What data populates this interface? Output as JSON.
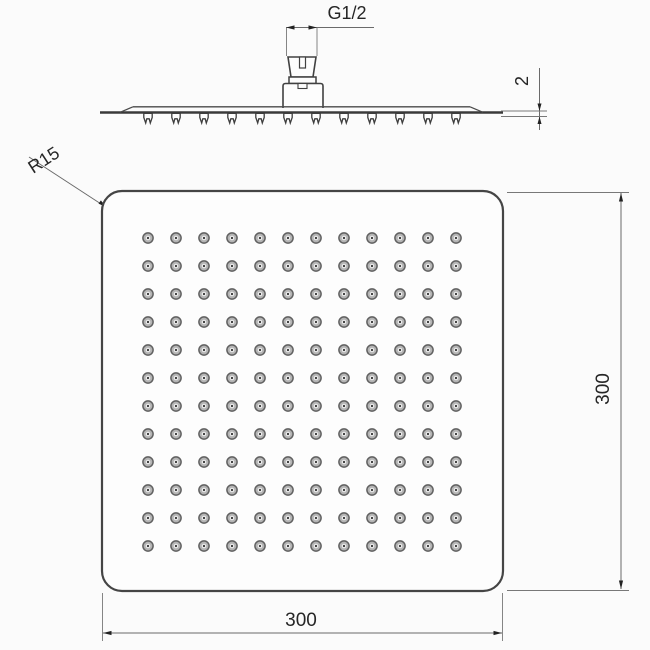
{
  "drawing": {
    "type": "technical-drawing",
    "side_view": {
      "thread_label": "G1/2",
      "thickness_label": "2"
    },
    "plan_view": {
      "corner_radius_label": "R15",
      "width_label": "300",
      "height_label": "300"
    },
    "nozzle_grid": {
      "rows": 12,
      "cols": 12
    },
    "colors": {
      "outline": "#414141",
      "dimension_line": "#6a6a6a",
      "background": "#fbfbfb",
      "nozzle_fill": "#b4b4b4",
      "text": "#262626"
    }
  }
}
